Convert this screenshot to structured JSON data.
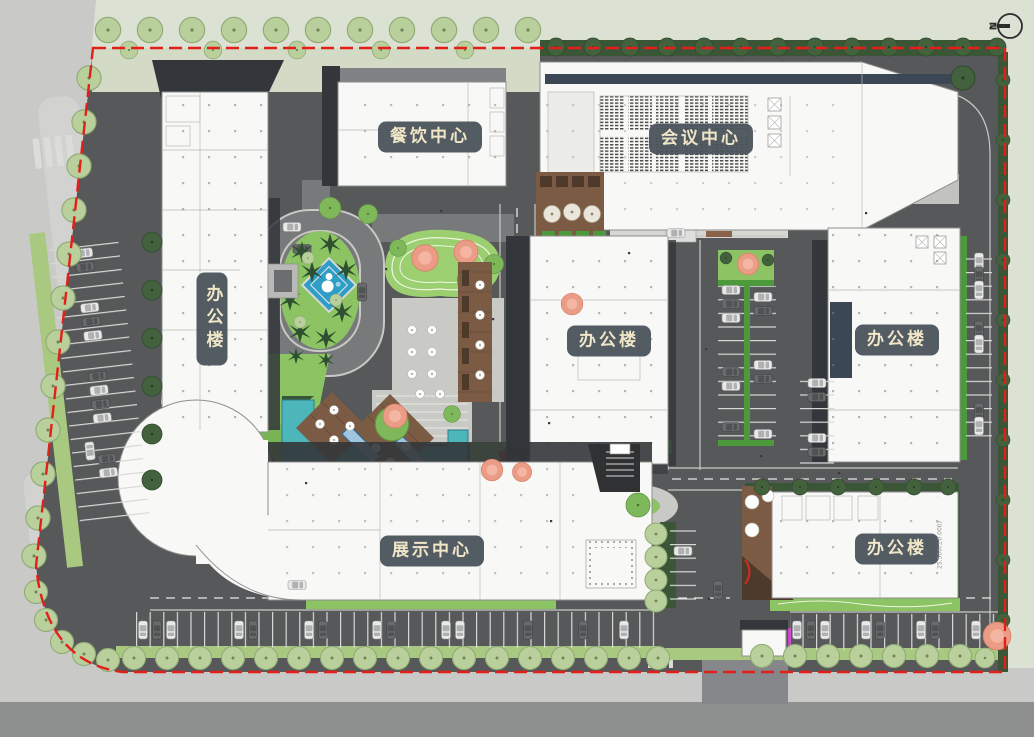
{
  "plan": {
    "labels": {
      "dining_center": "餐饮中心",
      "conference_center": "会议中心",
      "office_west": "办公楼",
      "office_center": "办公楼",
      "office_east": "办公楼",
      "office_southeast": "办公楼",
      "exhibition_center": "展示中心"
    },
    "north_letter": "N",
    "annotations": {
      "se_office_elevation": "25.500(±0.000)"
    },
    "colors": {
      "outside_green": "#dbe1d3",
      "street_gray": "#c9cac7",
      "street_dark": "#8e908f",
      "asphalt": "#56585a",
      "road_gray": "#77797b",
      "plaza_light": "#c9cac6",
      "curb_light": "#c8c9c5",
      "building_white": "#f8f8f6",
      "shadow_dark": "#33363a",
      "navy_strip": "#3b4754",
      "boundary_red": "#e31f1a",
      "label_bg": "#4b545c",
      "label_text": "#f0e6c6",
      "lawn_green": "#8cc363",
      "lawn_bright": "#9ccf6f",
      "verge_green": "#a9c981",
      "hedge_dark": "#3a5636",
      "bench_green": "#4c9a3c",
      "tree_light": "#b9cf9c",
      "tree_dark": "#44613e",
      "tree_pink": "#eb9c86",
      "tree_mid": "#7fb75b",
      "palm_green": "#2e5030",
      "water_teal": "#4cb6ba",
      "water_edge": "#2b7f8f",
      "pool_blue": "#2f9ec6",
      "deck_brown": "#7b5b43",
      "deck_dark": "#4e3a2b",
      "magenta": "#cc44cc",
      "red_accent": "#d42b20"
    }
  }
}
